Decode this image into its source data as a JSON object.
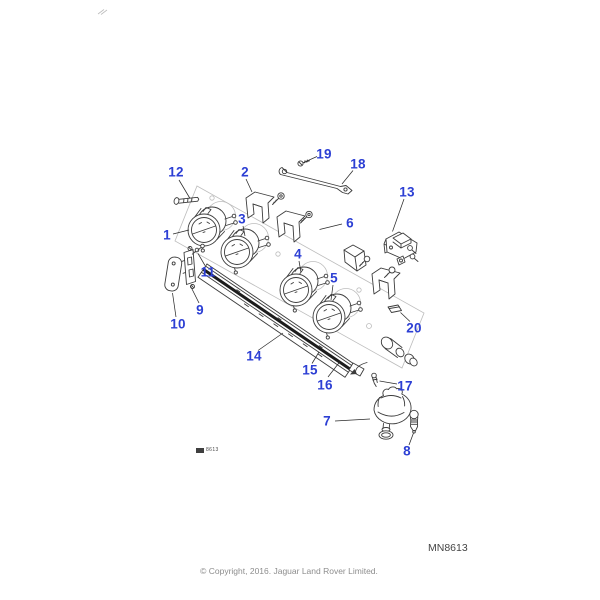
{
  "document": {
    "drawing_number": "MN8613",
    "copyright": "© Copyright, 2016. Jaguar Land Rover Limited.",
    "stamp_text": "8613"
  },
  "colors": {
    "blue": "#2c3fd4",
    "ink": "#3c3c3c",
    "faint": "#bdbdbd",
    "gray": "#8d8d8d",
    "strip_black": "#1c1c1c"
  },
  "callouts": [
    "1",
    "2",
    "3",
    "4",
    "5",
    "6",
    "7",
    "8",
    "9",
    "10",
    "11",
    "12",
    "13",
    "14",
    "15",
    "16",
    "17",
    "18",
    "19",
    "20"
  ]
}
